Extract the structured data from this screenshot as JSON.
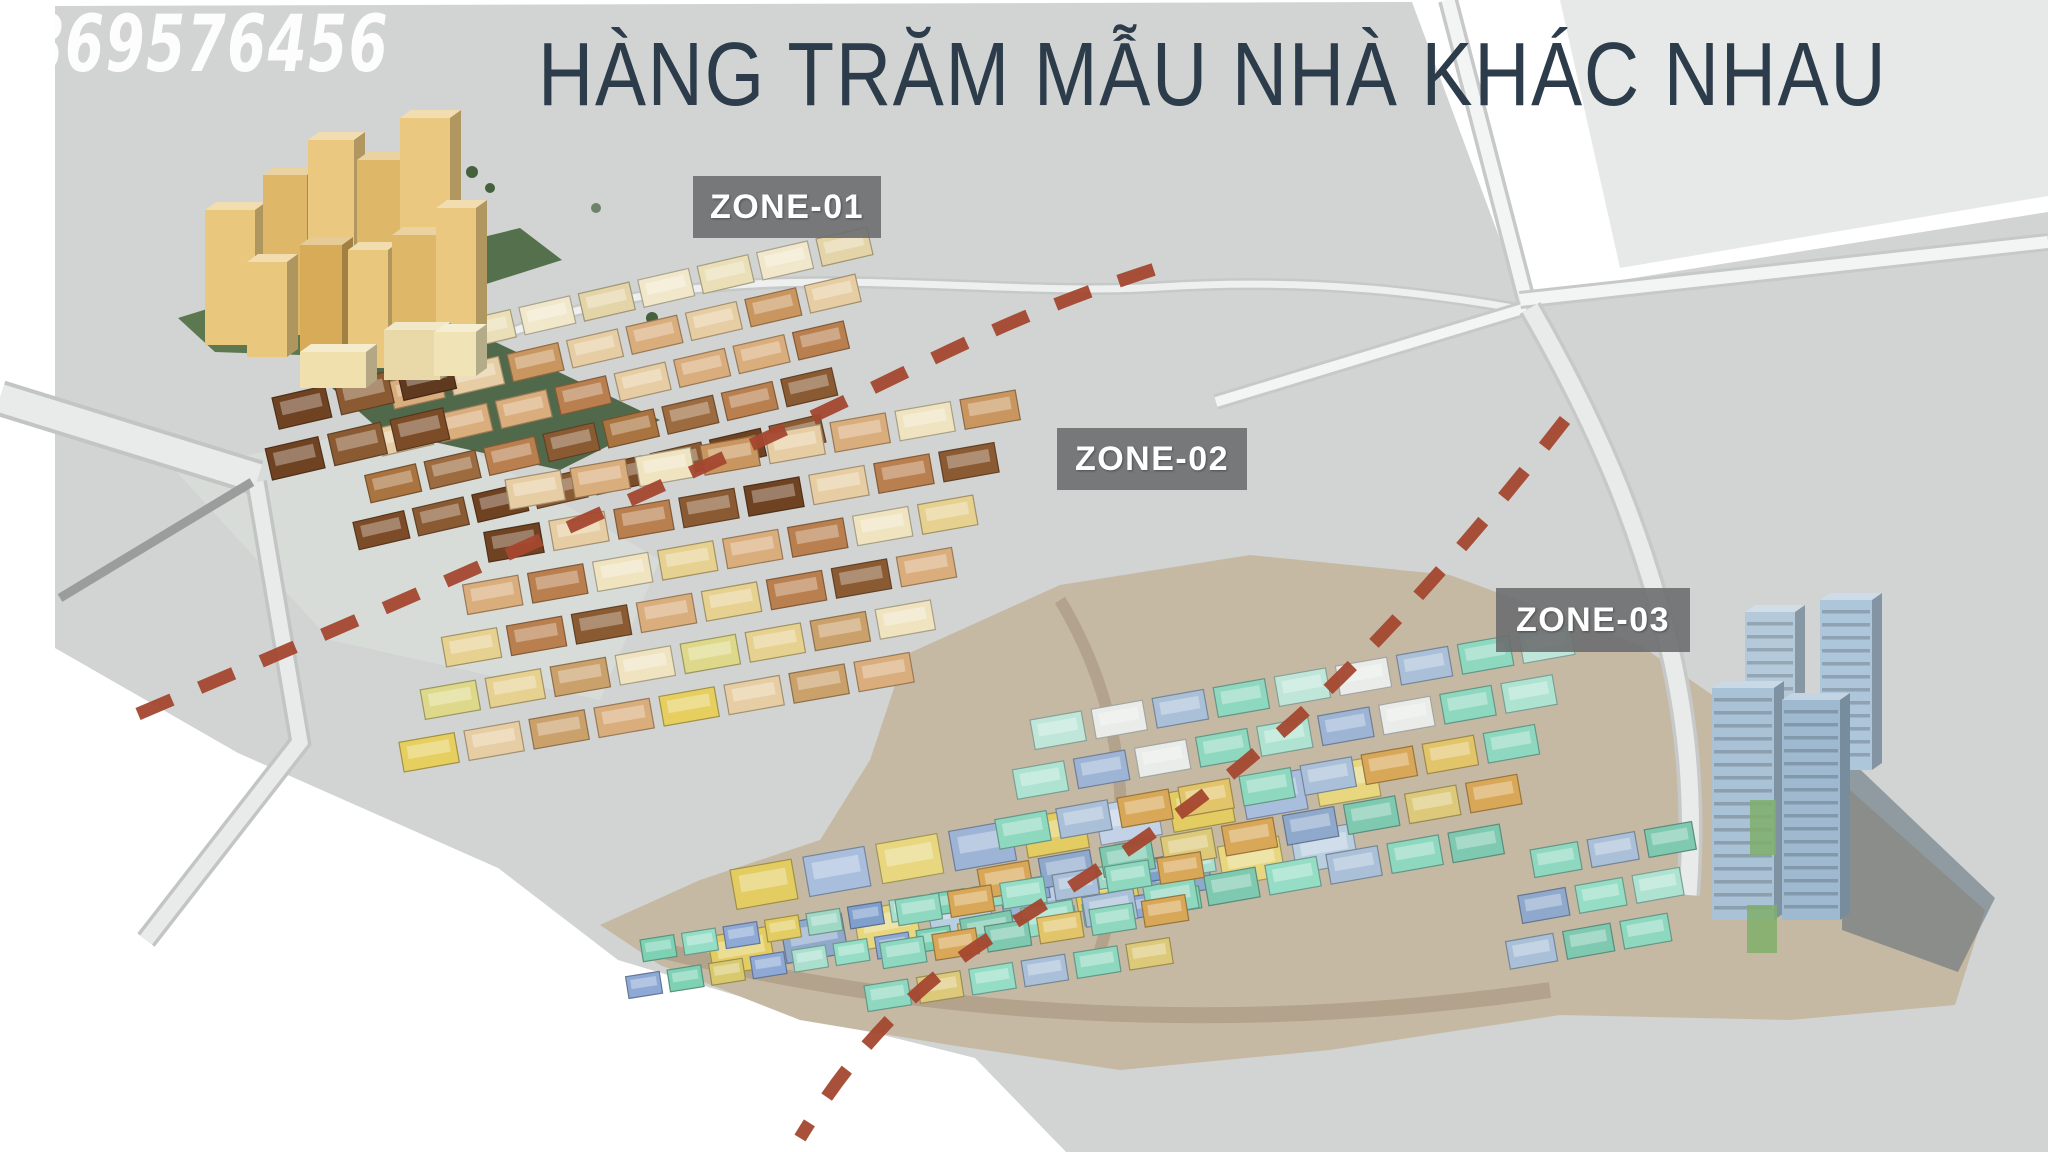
{
  "watermark": {
    "text": "0869576456"
  },
  "title": {
    "text": "HÀNG TRĂM MẪU NHÀ KHÁC NHAU",
    "color": "#2d3c4a"
  },
  "zones": [
    {
      "label": "ZONE-01"
    },
    {
      "label": "ZONE-02"
    },
    {
      "label": "ZONE-03"
    }
  ],
  "colors": {
    "background": "#ffffff",
    "terrain_gray": "#d1d4d2",
    "road_light": "#e9ebea",
    "zone_divider_dash": "#a4472f",
    "zone_label_background": "#6c6e70",
    "zone_label_text": "#ffffff",
    "title_text": "#2d3c4a",
    "watermark_text": "#ffffff",
    "highrise_tan": "#e9c87e",
    "rowhouse_cream": "#f1e8cc",
    "rowhouse_tan": "#d9ad7c",
    "rowhouse_brown": "#8a5a33",
    "midrise_yellow": "#e3cd62",
    "midrise_blue": "#9db4d6",
    "villa_teal": "#8fd8c0",
    "villa_mint": "#96ddc6",
    "villa_orange": "#d8a757",
    "platform_tan": "#c6b9a4",
    "lawn_green": "#50694a",
    "glass_tower_blue": "#aac3d8"
  }
}
